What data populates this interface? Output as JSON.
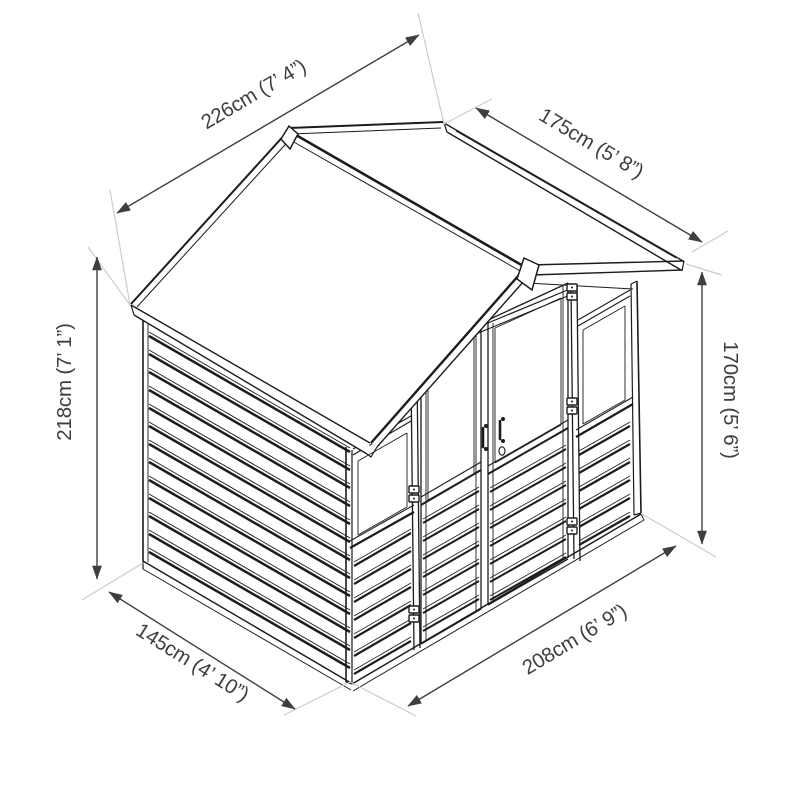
{
  "figure": {
    "subject": "summerhouse-isometric-dimension-drawing",
    "background": "#ffffff",
    "line_color": "#1c1c1c",
    "dimension_color": "#3e3e3e",
    "extension_color": "#cccccc",
    "dimensions": [
      {
        "id": "roof-width",
        "label": "226cm (7’ 4”)",
        "cm": 226,
        "imperial": "7' 4\""
      },
      {
        "id": "roof-depth",
        "label": "175cm (5’ 8”)",
        "cm": 175,
        "imperial": "5' 8\""
      },
      {
        "id": "ridge-height",
        "label": "218cm (7’ 1”)",
        "cm": 218,
        "imperial": "7' 1\""
      },
      {
        "id": "eaves-height",
        "label": "170cm (5’ 6”)",
        "cm": 170,
        "imperial": "5' 6\""
      },
      {
        "id": "depth",
        "label": "145cm (4’ 10”)",
        "cm": 145,
        "imperial": "4' 10\""
      },
      {
        "id": "width",
        "label": "208cm (6’ 9”)",
        "cm": 208,
        "imperial": "6' 9\""
      }
    ]
  }
}
